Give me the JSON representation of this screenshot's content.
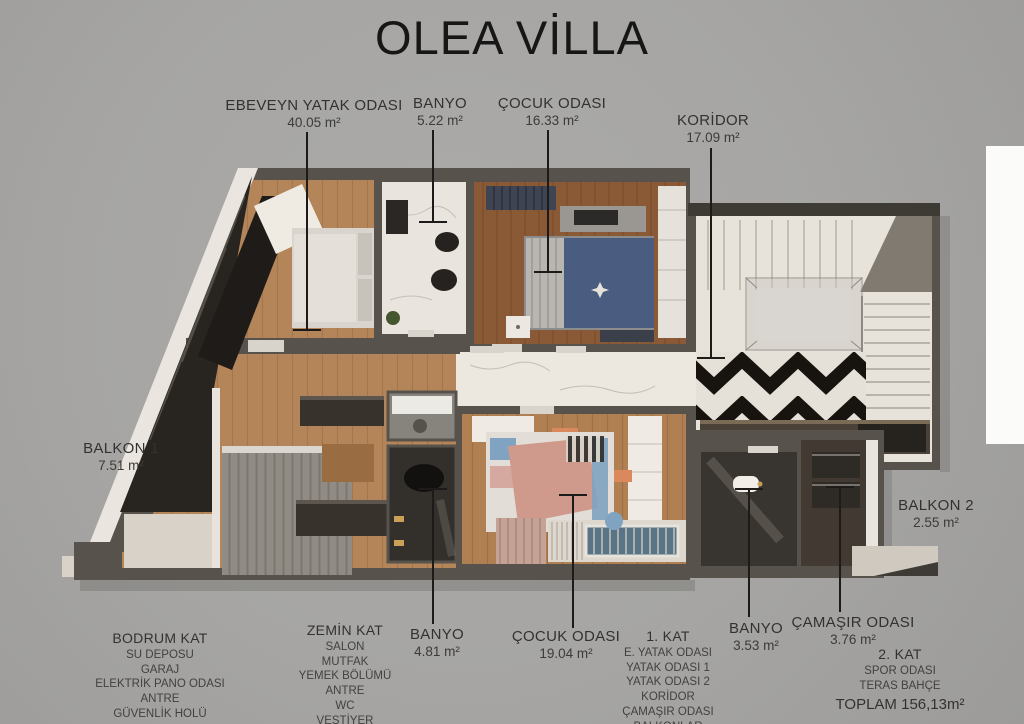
{
  "title": "OLEA VİLLA",
  "colors": {
    "background": "#a6a5a3",
    "wall": "#57524b",
    "wood_light": "#b5855a",
    "wood_dark": "#8a5a36",
    "marble": "#e9e4dc",
    "chevron_black": "#17140f",
    "accent_blue": "#7fa3c0",
    "accent_pink": "#cf9a8c",
    "text": "#3a3835",
    "title_text": "#161616",
    "leader": "#1c1b1a"
  },
  "room_labels": [
    {
      "label": "EBEVEYN YATAK ODASI",
      "area": "40.05 m²"
    },
    {
      "label": "BANYO",
      "area": "5.22 m²"
    },
    {
      "label": "ÇOCUK ODASI",
      "area": "16.33 m²"
    },
    {
      "label": "KORİDOR",
      "area": "17.09 m²"
    },
    {
      "label": "BALKON 1",
      "area": "7.51 m²"
    },
    {
      "label": "BALKON 2",
      "area": "2.55 m²"
    },
    {
      "label": "BANYO",
      "area": "4.81 m²"
    },
    {
      "label": "ÇOCUK ODASI",
      "area": "19.04 m²"
    },
    {
      "label": "BANYO",
      "area": "3.53 m²"
    },
    {
      "label": "ÇAMAŞIR ODASI",
      "area": "3.76 m²"
    }
  ],
  "floor_summaries": [
    {
      "title": "BODRUM KAT",
      "rooms": [
        "SU DEPOSU",
        "GARAJ",
        "ELEKTRİK PANO ODASI",
        "ANTRE",
        "GÜVENLİK HOLÜ"
      ],
      "total": "TOPLAM 226,52 m²"
    },
    {
      "title": "ZEMİN KAT",
      "rooms": [
        "SALON",
        "MUTFAK",
        "YEMEK BÖLÜMÜ",
        "ANTRE",
        "WC",
        "VESTİYER"
      ],
      "total": "TOPLAM 119,31m²"
    },
    {
      "title": "1. KAT",
      "rooms": [
        "E. YATAK ODASI",
        "YATAK ODASI 1",
        "YATAK ODASI 2",
        "KORİDOR",
        "ÇAMAŞIR ODASI",
        "BALKONLAR"
      ],
      "total": "TOPLAM 145,50 m²"
    },
    {
      "title": "2. KAT",
      "rooms": [
        "SPOR ODASI",
        "TERAS BAHÇE"
      ],
      "total": "TOPLAM 156,13m²"
    }
  ]
}
